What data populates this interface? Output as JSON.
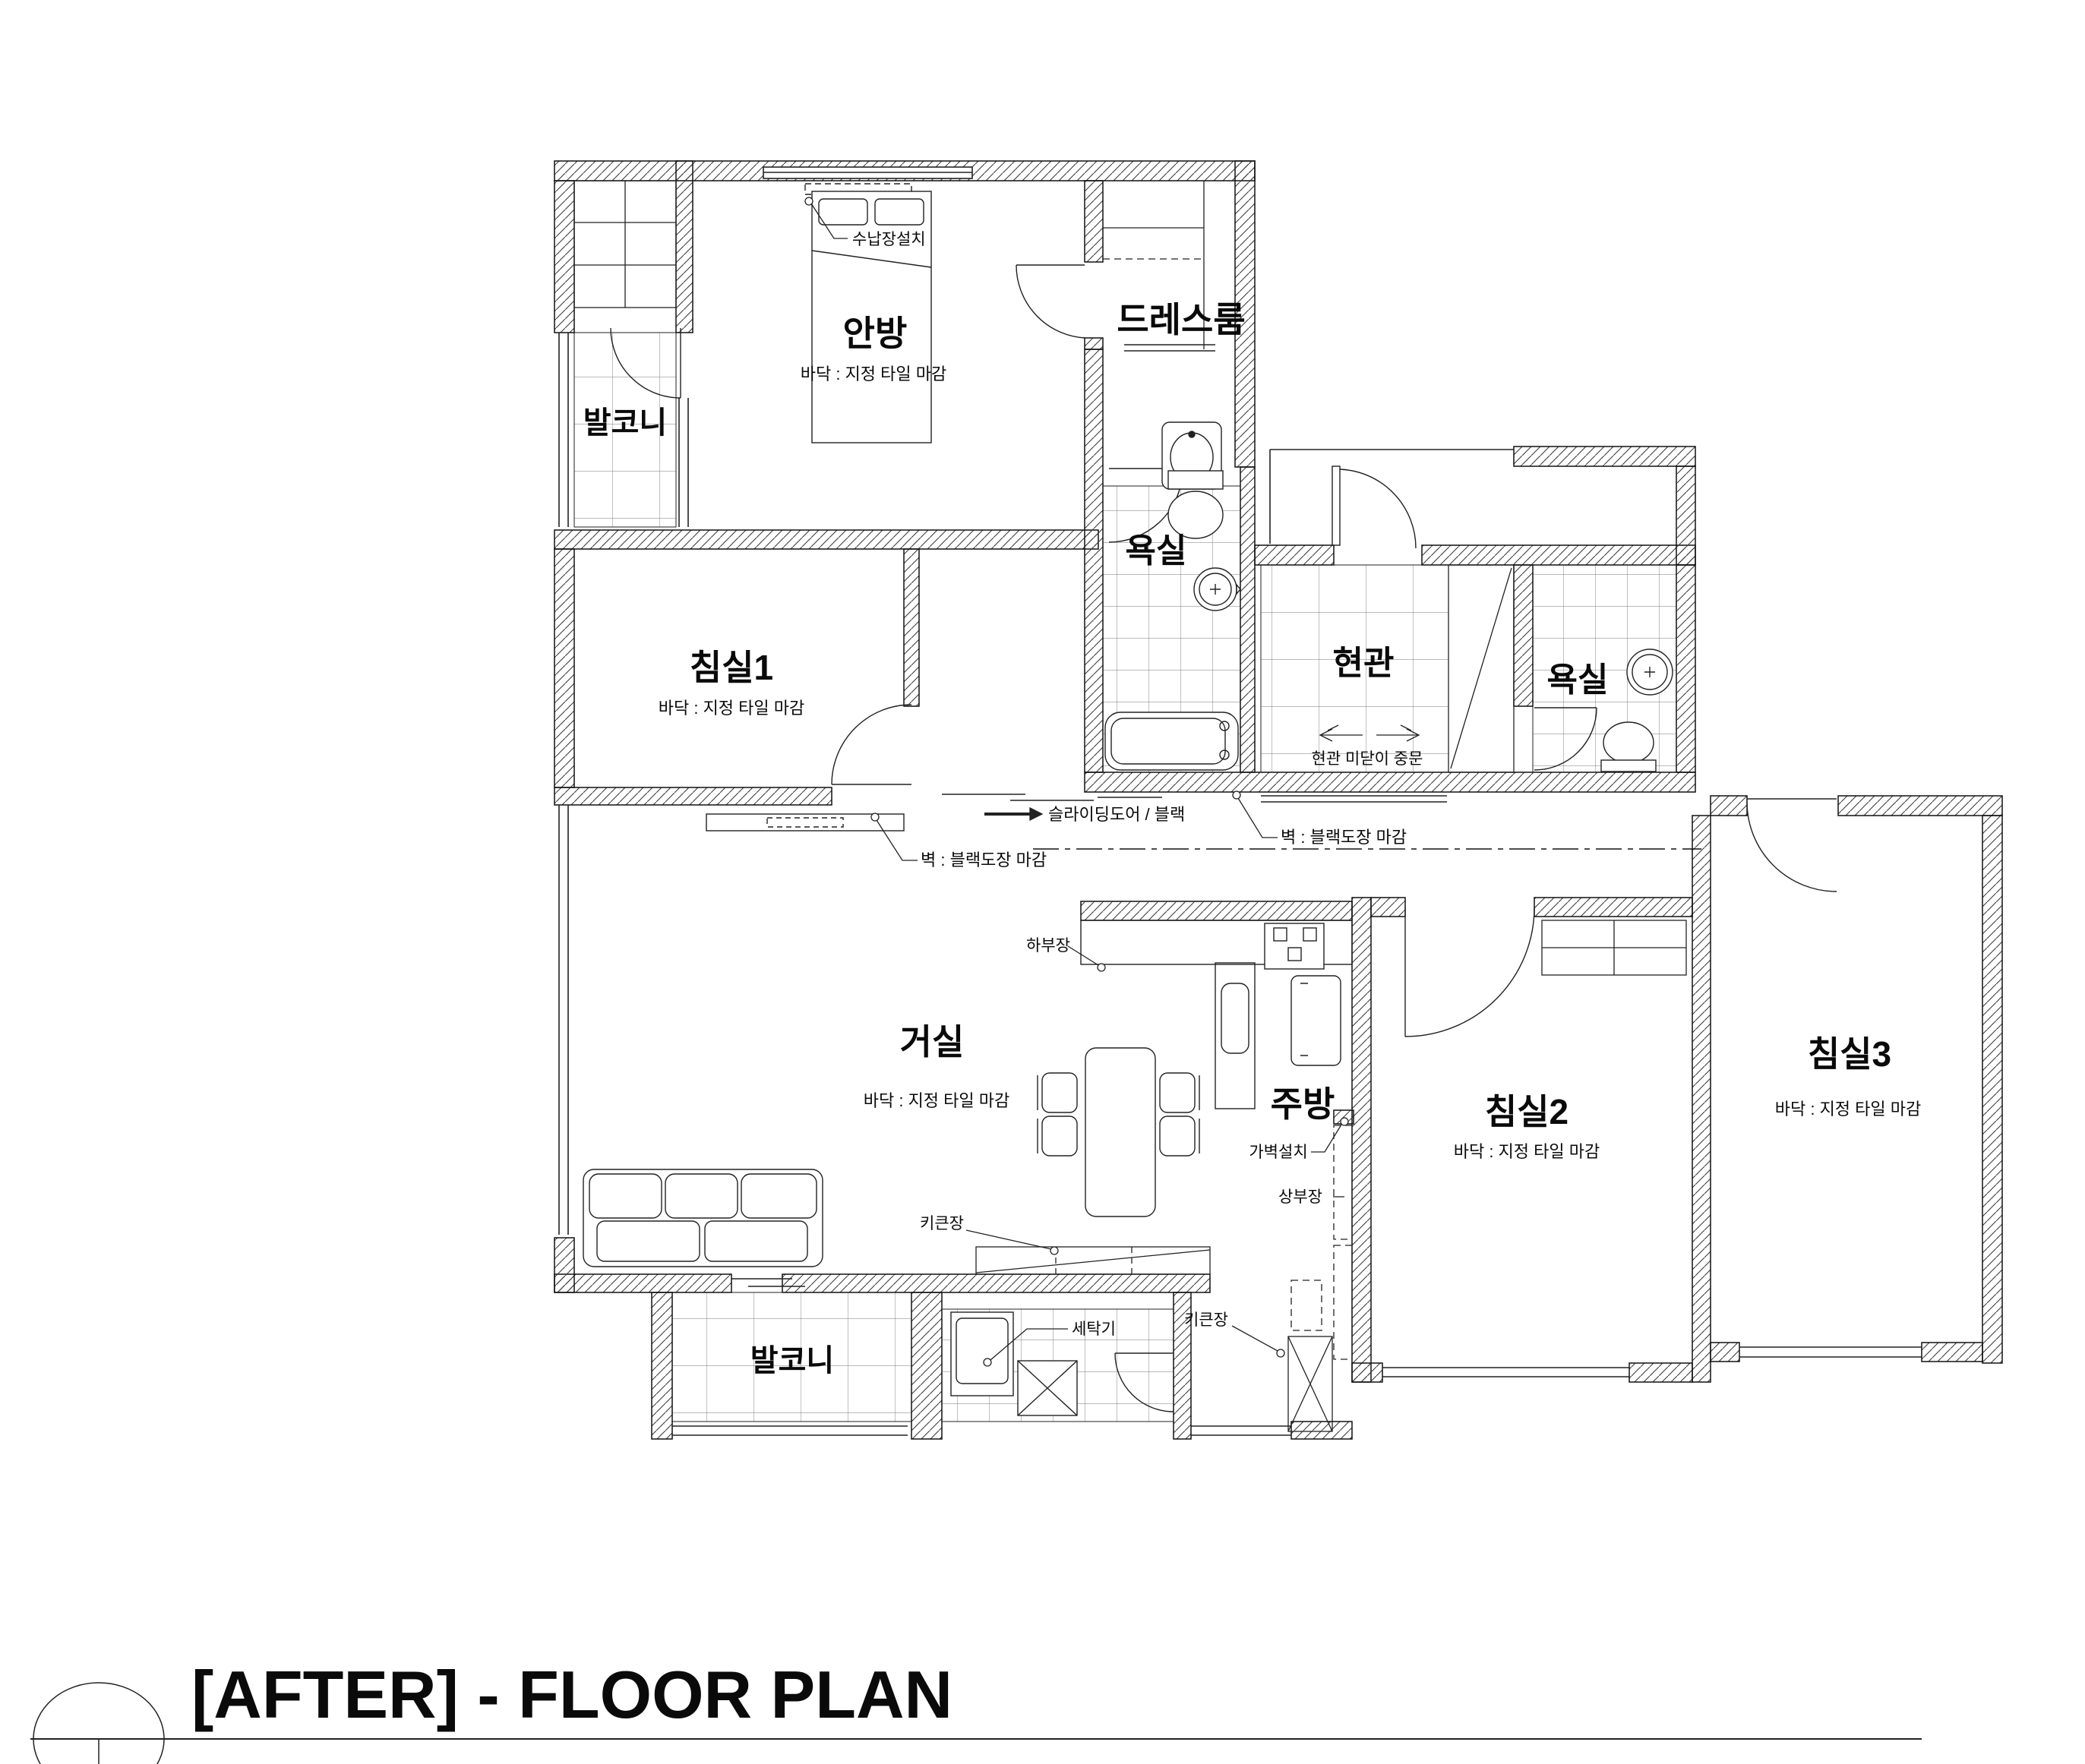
{
  "title": "[AFTER] - FLOOR PLAN",
  "rooms": {
    "anbang": {
      "label": "안방",
      "sub": "바닥 : 지정 타일 마감"
    },
    "dressroom": {
      "label": "드레스룸"
    },
    "balcony_top": {
      "label": "발코니"
    },
    "bedroom1": {
      "label": "침실1",
      "sub": "바닥 : 지정 타일 마감"
    },
    "bath1": {
      "label": "욕실"
    },
    "entrance": {
      "label": "현관"
    },
    "bath2": {
      "label": "욕실"
    },
    "living": {
      "label": "거실",
      "sub": "바닥 : 지정 타일 마감"
    },
    "kitchen": {
      "label": "주방"
    },
    "bedroom2": {
      "label": "침실2",
      "sub": "바닥 : 지정 타일 마감"
    },
    "bedroom3": {
      "label": "침실3",
      "sub": "바닥 : 지정 타일 마감"
    },
    "balcony_bottom": {
      "label": "발코니"
    }
  },
  "annotations": {
    "storage_install": "수납장설치",
    "sliding_door": "슬라이딩도어 / 블랙",
    "wall_black_left": "벽 : 블랙도장 마감",
    "wall_black_right": "벽 : 블랙도장 마감",
    "lower_cabinet": "하부장",
    "partition_wall": "가벽설치",
    "upper_cabinet": "상부장",
    "tall_cabinet_1": "키큰장",
    "washer": "세탁기",
    "tall_cabinet_2": "키큰장",
    "entrance_sliding_door": "현관 미닫이 중문"
  }
}
